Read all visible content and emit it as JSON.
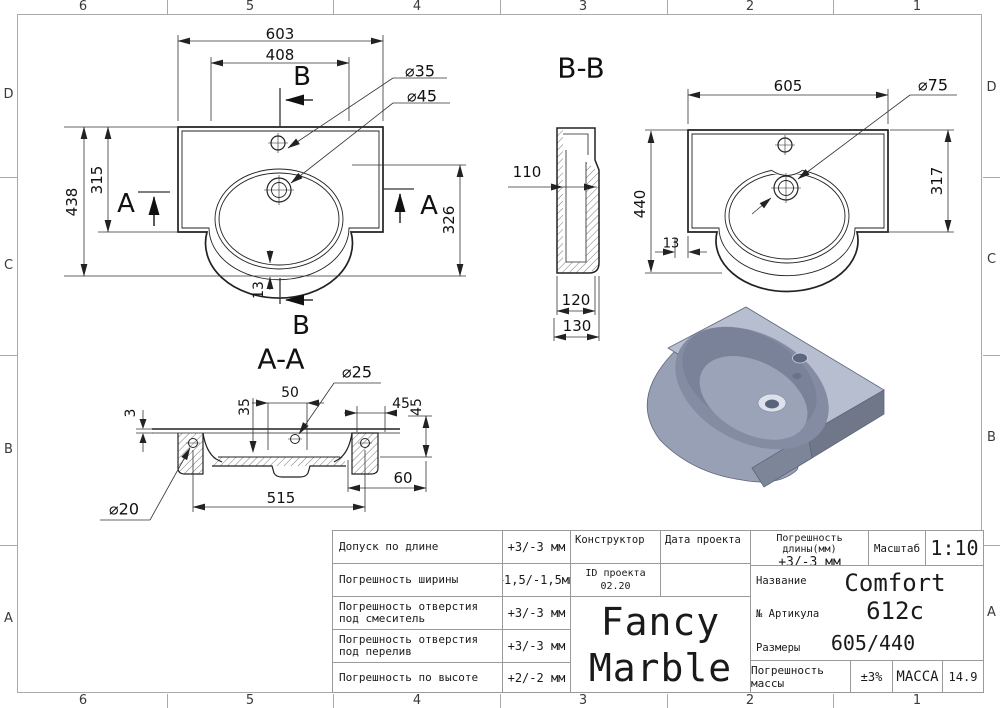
{
  "frame": {
    "columns": [
      "6",
      "5",
      "4",
      "3",
      "2",
      "1"
    ],
    "rows": [
      "D",
      "C",
      "B",
      "A"
    ]
  },
  "drawing": {
    "plan": {
      "dim_total_width": "603",
      "dim_inner_width": "408",
      "dim_total_height": "438",
      "dim_body_height": "315",
      "dim_basin_height": "326",
      "dim_rim": "13",
      "label_faucet": "⌀35",
      "label_drain": "⌀45",
      "marker_b": "B",
      "marker_a": "A"
    },
    "side": {
      "dim_inner_depth": "110",
      "dim_body_depth": "120",
      "dim_total_depth": "130"
    },
    "bb": {
      "title": "B-B",
      "dim_width": "605",
      "label_drain": "⌀75",
      "dim_total_height": "440",
      "dim_body_height": "317",
      "dim_offset": "13"
    },
    "aa": {
      "title": "A-A",
      "label_overflow": "⌀25",
      "dim_top": "3",
      "dim_depth": "35",
      "dim_span": "50",
      "dim_back": "45",
      "dim_drop": "45",
      "dim_tab": "60",
      "dim_mounts": "515",
      "label_mount": "⌀20"
    }
  },
  "title_block": {
    "tolerances": [
      {
        "label": "Допуск по длине",
        "value": "+3/-3 мм"
      },
      {
        "label": "Погрешность ширины",
        "value": "+1,5/-1,5мм"
      },
      {
        "label": "Погрешность отверстия под смеситель",
        "value": "+3/-3 мм"
      },
      {
        "label": "Погрешность отверстия под перелив",
        "value": "+3/-3 мм"
      },
      {
        "label": "Погрешность по высоте",
        "value": "+2/-2 мм"
      }
    ],
    "constructor_label": "Конструктор",
    "project_date_label": "Дата проекта",
    "project_id_label": "ID проекта",
    "project_id_value": "02.20",
    "brand_line1": "Fancy",
    "brand_line2": "Marble",
    "length_tolerance_label": "Погрешность длины(мм)",
    "length_tolerance_value": "+3/-3 мм",
    "scale_label": "Масштаб",
    "scale_value": "1:10",
    "name_label": "Название",
    "name_value": "Comfort 612c",
    "article_label": "№ Артикула",
    "sizes_label": "Размеры",
    "sizes_value": "605/440",
    "mass_tolerance_label": "Погрешность массы",
    "mass_tolerance_value": "±3%",
    "mass_label": "МАССА",
    "mass_value": "14.9"
  },
  "colors": {
    "line": "#222222",
    "frame": "#aaaaaa",
    "render_top": "#b6becf",
    "render_side": "#98a0b5",
    "render_dark": "#6f7789",
    "render_bowl": "#848ca4"
  }
}
